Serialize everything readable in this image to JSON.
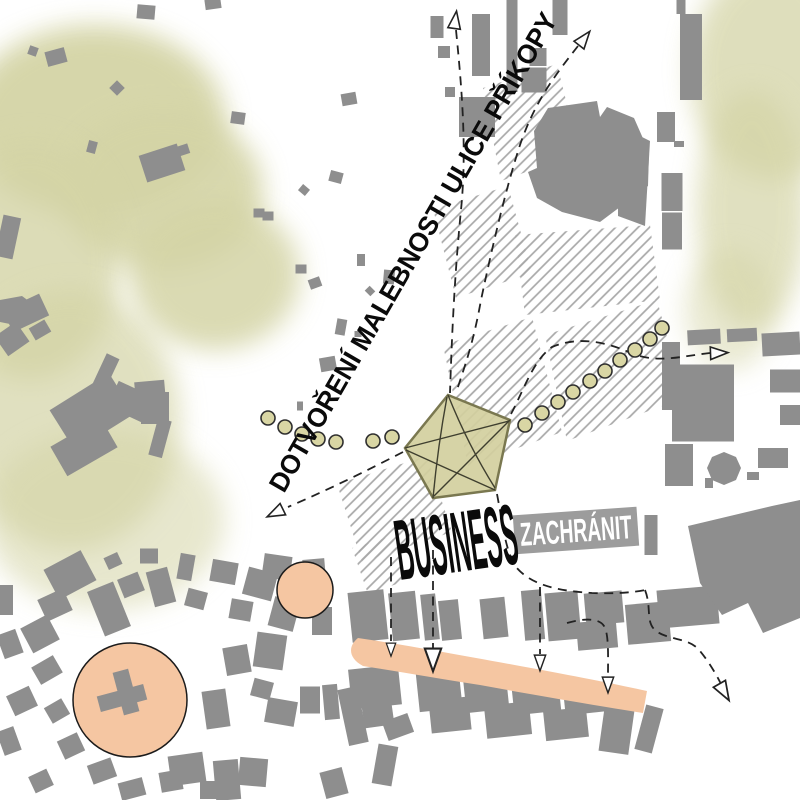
{
  "map": {
    "labels": {
      "street_annotation": "DOTVOŘENÍ MALEBNOSTI ULICE PŘÍKOPY",
      "business": "BUSINESS",
      "zachranit": "ZACHRÁNIT"
    },
    "colors": {
      "building": "#8e8e8e",
      "hatch_line": "#a8a8a8",
      "green_wash": "#d4d4a6",
      "salmon": "#f5c6a2",
      "pentagon_fill": "#d3cf9e",
      "pentagon_stroke": "#7a7850",
      "pentagon_chord": "#3f3f2f",
      "dot_fill": "#d9d6a4",
      "dot_stroke": "#2e2e2e",
      "route_line": "#222222",
      "badge_bg": "#9c9c9c",
      "badge_text": "#ffffff",
      "label_text": "#0a0a0a"
    },
    "green_blobs": [
      [
        95,
        120,
        130,
        95,
        0.95
      ],
      [
        163,
        190,
        100,
        80,
        0.9
      ],
      [
        30,
        260,
        90,
        120,
        0.8
      ],
      [
        70,
        420,
        110,
        130,
        0.7
      ],
      [
        105,
        520,
        120,
        90,
        0.55
      ],
      [
        215,
        275,
        85,
        75,
        0.85
      ],
      [
        775,
        70,
        85,
        110,
        0.75
      ],
      [
        752,
        210,
        55,
        120,
        0.7
      ],
      [
        730,
        310,
        45,
        60,
        0.5
      ]
    ],
    "hatch_blocks": [
      "483,88 557,64 579,153 501,181",
      "433,209 508,186 532,273 456,298",
      "515,235 650,225 660,300 525,315",
      "545,335 657,300 684,398 567,441",
      "443,345 532,317 562,432 468,466",
      "337,484 427,456 452,532 362,562",
      "352,548 392,536 408,580 368,594"
    ],
    "building_polygons": [
      "548,108 597,101 600,117 607,107 634,118 649,152 648,186 600,222 562,212 537,198 528,172 537,168 534,131",
      "618,125 650,141 645,226 618,216",
      "688,526 772,506 800,500 800,618 763,633 748,603 722,615 700,583",
      "724,452 736,457 741,468 736,480 724,485 712,480 707,468 712,457",
      "0,300 22,296 38,308 20,326 0,322"
    ],
    "buildings": [
      [
        146,
        12,
        18,
        14,
        5
      ],
      [
        213,
        4,
        16,
        10,
        -8
      ],
      [
        56,
        57,
        20,
        15,
        -15
      ],
      [
        33,
        51,
        9,
        9,
        20
      ],
      [
        117,
        88,
        11,
        11,
        45
      ],
      [
        238,
        118,
        14,
        12,
        8
      ],
      [
        92,
        147,
        9,
        12,
        15
      ],
      [
        162,
        163,
        40,
        28,
        -18
      ],
      [
        183,
        150,
        12,
        10,
        -18
      ],
      [
        8,
        237,
        18,
        42,
        12
      ],
      [
        259,
        213,
        11,
        9,
        0
      ],
      [
        301,
        269,
        11,
        9,
        0
      ],
      [
        315,
        283,
        12,
        10,
        -20
      ],
      [
        361,
        260,
        8,
        12,
        0
      ],
      [
        389,
        277,
        11,
        14,
        5
      ],
      [
        370,
        291,
        8,
        7,
        45
      ],
      [
        341,
        327,
        10,
        16,
        10
      ],
      [
        358,
        334,
        7,
        6,
        0
      ],
      [
        328,
        364,
        16,
        14,
        -10
      ],
      [
        300,
        406,
        6,
        9,
        0
      ],
      [
        349,
        99,
        15,
        12,
        -10
      ],
      [
        336,
        177,
        13,
        11,
        15
      ],
      [
        304,
        190,
        9,
        8,
        40
      ],
      [
        268,
        216,
        11,
        9,
        0
      ],
      [
        437,
        27,
        13,
        22,
        0
      ],
      [
        444,
        52,
        12,
        12,
        0
      ],
      [
        450,
        92,
        10,
        10,
        0
      ],
      [
        481,
        45,
        18,
        62,
        0
      ],
      [
        512,
        46,
        11,
        92,
        0
      ],
      [
        560,
        17,
        15,
        36,
        0
      ],
      [
        538,
        57,
        17,
        18,
        0
      ],
      [
        534,
        80,
        25,
        25,
        0
      ],
      [
        477,
        117,
        36,
        40,
        0
      ],
      [
        681,
        7,
        9,
        14,
        0
      ],
      [
        691,
        57,
        22,
        86,
        0
      ],
      [
        666,
        127,
        18,
        30,
        0
      ],
      [
        679,
        144,
        10,
        6,
        0
      ],
      [
        672,
        192,
        21,
        38,
        0
      ],
      [
        672,
        231,
        20,
        37,
        0
      ],
      [
        704,
        337,
        33,
        15,
        -3
      ],
      [
        742,
        335,
        30,
        13,
        -3
      ],
      [
        781,
        344,
        38,
        23,
        -3
      ],
      [
        671,
        376,
        18,
        68,
        0
      ],
      [
        703,
        403,
        62,
        77,
        0
      ],
      [
        785,
        381,
        30,
        23,
        0
      ],
      [
        790,
        415,
        20,
        20,
        0
      ],
      [
        773,
        458,
        30,
        20,
        0
      ],
      [
        679,
        465,
        28,
        42,
        0
      ],
      [
        753,
        476,
        12,
        8,
        0
      ],
      [
        709,
        483,
        8,
        10,
        0
      ],
      [
        651,
        535,
        13,
        40,
        0
      ],
      [
        26,
        313,
        40,
        24,
        -25
      ],
      [
        12,
        339,
        26,
        24,
        -35
      ],
      [
        40,
        330,
        18,
        14,
        -30
      ],
      [
        103,
        378,
        14,
        48,
        25
      ],
      [
        131,
        402,
        40,
        28,
        25
      ],
      [
        155,
        408,
        28,
        32,
        0
      ],
      [
        160,
        438,
        14,
        38,
        15
      ],
      [
        92,
        412,
        70,
        48,
        -32
      ],
      [
        84,
        447,
        58,
        34,
        -30
      ],
      [
        150,
        391,
        30,
        20,
        -5
      ],
      [
        143,
        404,
        8,
        12,
        -5
      ],
      [
        70,
        575,
        42,
        34,
        -28
      ],
      [
        55,
        605,
        28,
        24,
        -25
      ],
      [
        40,
        634,
        30,
        28,
        -28
      ],
      [
        109,
        609,
        28,
        48,
        -22
      ],
      [
        131,
        585,
        22,
        20,
        -22
      ],
      [
        113,
        561,
        15,
        13,
        -25
      ],
      [
        149,
        556,
        18,
        15,
        0
      ],
      [
        161,
        587,
        22,
        36,
        -15
      ],
      [
        186,
        567,
        15,
        26,
        10
      ],
      [
        196,
        599,
        20,
        18,
        15
      ],
      [
        224,
        572,
        26,
        22,
        10
      ],
      [
        260,
        584,
        30,
        28,
        15
      ],
      [
        241,
        610,
        22,
        20,
        10
      ],
      [
        284,
        614,
        26,
        30,
        15
      ],
      [
        277,
        567,
        28,
        24,
        8
      ],
      [
        314,
        568,
        22,
        18,
        -5
      ],
      [
        6,
        600,
        14,
        30,
        0
      ],
      [
        10,
        644,
        20,
        25,
        -20
      ],
      [
        47,
        670,
        25,
        20,
        -30
      ],
      [
        22,
        701,
        25,
        22,
        -25
      ],
      [
        57,
        711,
        20,
        18,
        -30
      ],
      [
        9,
        741,
        18,
        25,
        -20
      ],
      [
        71,
        746,
        22,
        20,
        -25
      ],
      [
        102,
        771,
        25,
        20,
        -20
      ],
      [
        41,
        781,
        20,
        18,
        -25
      ],
      [
        132,
        789,
        25,
        18,
        -15
      ],
      [
        171,
        781,
        22,
        20,
        -10
      ],
      [
        210,
        790,
        20,
        18,
        0
      ],
      [
        216,
        709,
        24,
        38,
        -8
      ],
      [
        262,
        689,
        20,
        18,
        15
      ],
      [
        187,
        769,
        35,
        30,
        -8
      ],
      [
        227,
        780,
        25,
        40,
        -5
      ],
      [
        281,
        712,
        30,
        25,
        10
      ],
      [
        310,
        700,
        20,
        27,
        0
      ],
      [
        331,
        702,
        15,
        35,
        -5
      ],
      [
        353,
        716,
        20,
        57,
        -12
      ],
      [
        377,
        708,
        30,
        37,
        -8
      ],
      [
        398,
        727,
        27,
        20,
        -20
      ],
      [
        385,
        765,
        20,
        40,
        10
      ],
      [
        334,
        783,
        23,
        27,
        -15
      ],
      [
        253,
        772,
        28,
        28,
        5
      ],
      [
        270,
        651,
        30,
        35,
        8
      ],
      [
        237,
        660,
        25,
        28,
        -10
      ],
      [
        322,
        621,
        20,
        28,
        0
      ],
      [
        368,
        616,
        36,
        50,
        -6
      ],
      [
        404,
        616,
        27,
        48,
        -6
      ],
      [
        430,
        617,
        15,
        46,
        -6
      ],
      [
        450,
        620,
        20,
        40,
        -6
      ],
      [
        494,
        618,
        25,
        40,
        -6
      ],
      [
        533,
        615,
        20,
        50,
        -5
      ],
      [
        563,
        616,
        33,
        48,
        -5
      ],
      [
        604,
        608,
        38,
        32,
        -5
      ],
      [
        648,
        623,
        43,
        40,
        -5
      ],
      [
        597,
        635,
        40,
        28,
        -5
      ],
      [
        688,
        607,
        60,
        38,
        -5
      ],
      [
        375,
        687,
        50,
        40,
        -6
      ],
      [
        439,
        689,
        43,
        42,
        -6
      ],
      [
        486,
        692,
        43,
        38,
        -6
      ],
      [
        536,
        695,
        47,
        36,
        -6
      ],
      [
        589,
        698,
        50,
        30,
        -6
      ],
      [
        617,
        727,
        30,
        52,
        8
      ],
      [
        649,
        729,
        18,
        46,
        15
      ],
      [
        450,
        715,
        40,
        33,
        -6
      ],
      [
        508,
        720,
        45,
        33,
        -6
      ],
      [
        566,
        724,
        43,
        30,
        -6
      ]
    ],
    "salmon_band": "M358,638 C400,644 460,655 520,666 C570,675 615,684 647,691 L643,713 C600,706 540,696 480,685 C435,678 395,671 363,666 C348,658 348,646 358,638 Z",
    "salmon_circles": [
      {
        "cx": 130,
        "cy": 700,
        "r": 57
      },
      {
        "cx": 305,
        "cy": 590,
        "r": 28
      }
    ],
    "church": [
      [
        122,
        698,
        48,
        16,
        -15
      ],
      [
        126,
        692,
        16,
        44,
        -15
      ]
    ],
    "pentagon": {
      "points": "448,395 510,420 495,490 433,498 405,448",
      "chords": [
        "M448,395 Q468,445 495,488",
        "M495,490 Q450,470 406,450",
        "M405,448 Q455,435 509,421",
        "M510,420 Q470,460 434,496",
        "M433,498 Q438,445 447,397"
      ]
    },
    "dashed_routes": [
      "M456,30 C462,90 467,150 461,210 C455,270 452,330 450,393",
      "M578,46 C556,74 534,102 519,148 C505,192 492,248 481,300 C473,345 464,368 457,390",
      "M403,452 C368,470 330,489 288,507",
      "M511,414 C523,392 533,360 552,347 C576,337 602,340 631,353 C657,364 682,356 710,353",
      "M497,494 C503,525 505,550 516,567 C532,586 560,591 592,593 C618,594 636,592 645,590",
      "M645,590 C652,608 645,622 656,631 C670,641 689,637 700,651 C709,662 716,674 721,684",
      "M391,557 L391,641",
      "M433,550 L433,648",
      "M540,587 L540,654",
      "M567,623 C584,618 599,618 604,626 C609,634 608,656 608,676"
    ],
    "arrows": [
      [
        455,
        22,
        8,
        1
      ],
      [
        583,
        40,
        38,
        1
      ],
      [
        277,
        512,
        244,
        1
      ],
      [
        717,
        353,
        88,
        1
      ],
      [
        391,
        648,
        180,
        0.75
      ],
      [
        433,
        657,
        180,
        1.3
      ],
      [
        540,
        661,
        180,
        0.9
      ],
      [
        608,
        683,
        180,
        0.9
      ],
      [
        723,
        690,
        150,
        1.1
      ]
    ],
    "dotted_trails": [
      [
        [
          268,
          418
        ],
        [
          285,
          427
        ],
        [
          302,
          434
        ],
        [
          318,
          439
        ],
        [
          336,
          442
        ],
        [
          373,
          441
        ],
        [
          392,
          437
        ]
      ],
      [
        [
          525,
          425
        ],
        [
          542,
          413
        ],
        [
          558,
          402
        ],
        [
          573,
          392
        ],
        [
          590,
          381
        ],
        [
          605,
          371
        ],
        [
          620,
          360
        ],
        [
          635,
          350
        ],
        [
          650,
          339
        ],
        [
          662,
          328
        ]
      ]
    ],
    "dot_radius": 7
  }
}
